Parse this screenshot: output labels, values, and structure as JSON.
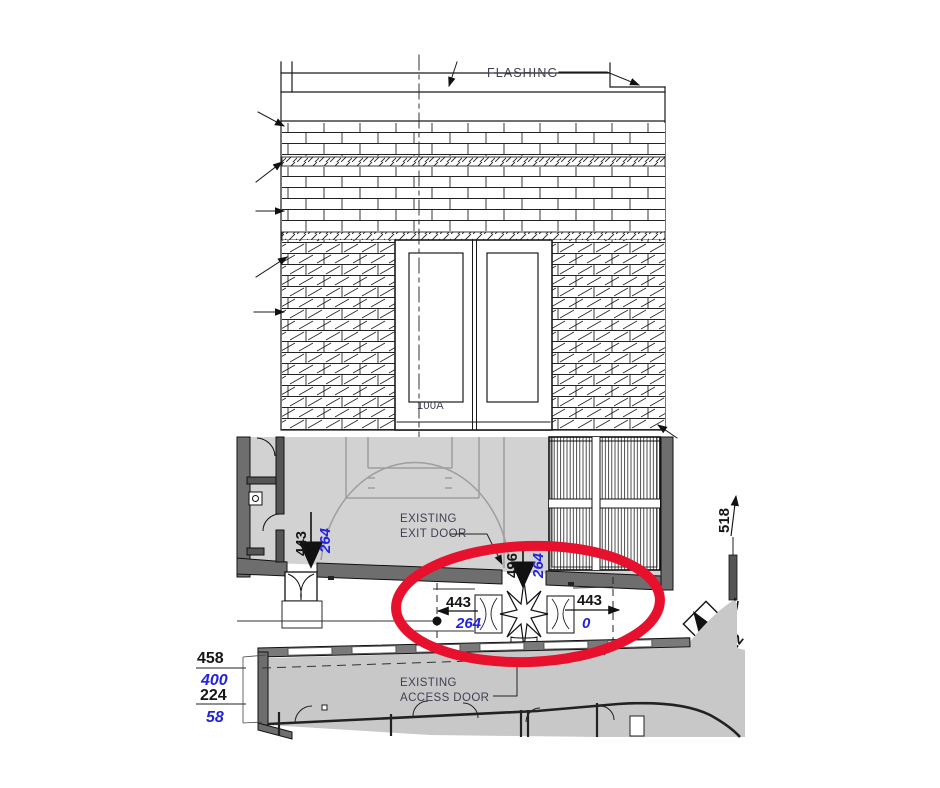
{
  "colors": {
    "highlight_red": "#e8112d",
    "dimension_blue": "#2323dd",
    "annotation_slate": "#3f3f51",
    "line_black": "#1a1a1a",
    "gym_floor_gray": "#d2d2d2",
    "building_gray": "#c8c8c8",
    "wall_gray": "#6e6e6e",
    "court_line_gray": "#9e9e9e"
  },
  "elevation": {
    "flashing_label": "FLASHING",
    "door_tag": "100A"
  },
  "plan": {
    "exit_door_label": {
      "line1": "EXISTING",
      "line2": "EXIT DOOR"
    },
    "access_door_label": {
      "line1": "EXISTING",
      "line2": "ACCESS DOOR"
    },
    "dimensions": {
      "gym_door_width": "443",
      "gym_door_offset": "264",
      "center_width": "496",
      "center_offset": "264",
      "left_width": "443",
      "left_offset": "264",
      "right_width": "443",
      "right_offset": "0",
      "east_wall": "518",
      "corner_door": "22",
      "corner_offset": "0",
      "west_1": "458",
      "west_2": "400",
      "west_3": "224",
      "west_4": "58"
    }
  }
}
